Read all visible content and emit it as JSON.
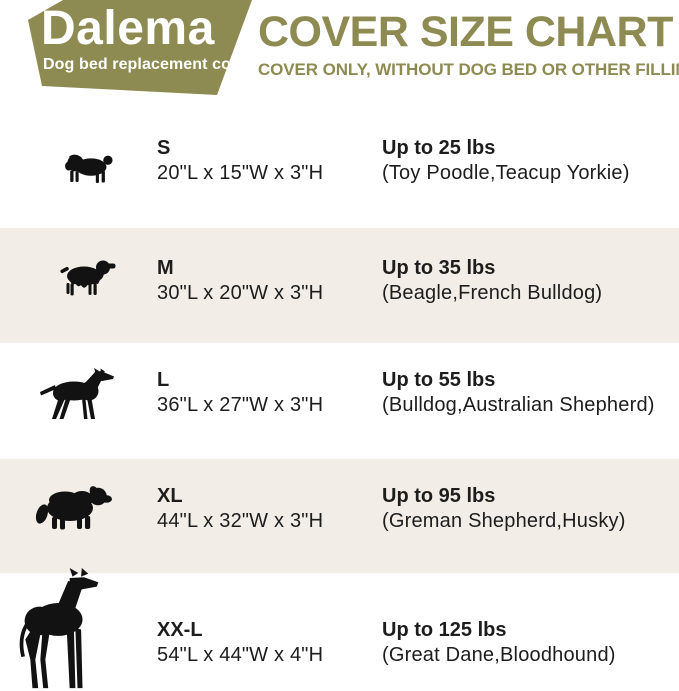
{
  "brand": {
    "name": "Dalema",
    "tagline": "Dog bed replacement cover"
  },
  "header": {
    "title": "COVER SIZE CHART",
    "subtitle": "COVER ONLY, WITHOUT DOG BED OR OTHER FILLINGS"
  },
  "colors": {
    "olive": "#8e8b52",
    "row_alt": "#f2ede6",
    "text": "#1d1d1d",
    "silhouette": "#121212",
    "background": "#ffffff"
  },
  "size_rows": [
    {
      "size": "S",
      "dimensions": "20\"L x 15\"W x 3\"H",
      "weight": "Up to 25 lbs",
      "breeds": "(Toy Poodle,Teacup Yorkie)",
      "icon": "pug-silhouette"
    },
    {
      "size": "M",
      "dimensions": "30\"L x 20\"W x 3\"H",
      "weight": "Up to 35 lbs",
      "breeds": "(Beagle,French Bulldog)",
      "icon": "cocker-spaniel-silhouette"
    },
    {
      "size": "L",
      "dimensions": "36\"L x 27\"W x 3\"H",
      "weight": "Up to 55 lbs",
      "breeds": "(Bulldog,Australian Shepherd)",
      "icon": "doberman-silhouette"
    },
    {
      "size": "XL",
      "dimensions": "44\"L x 32\"W x 3\"H",
      "weight": "Up to 95 lbs",
      "breeds": "(Greman Shepherd,Husky)",
      "icon": "bernese-mountain-dog-silhouette"
    },
    {
      "size": "XX-L",
      "dimensions": "54\"L x 44\"W x 4\"H",
      "weight": "Up to 125 lbs",
      "breeds": "(Great Dane,Bloodhound)",
      "icon": "great-dane-silhouette"
    }
  ],
  "chart_data": {
    "type": "table",
    "title": "COVER SIZE CHART",
    "subtitle": "COVER ONLY, WITHOUT DOG BED OR OTHER FILLINGS",
    "columns": [
      "Size",
      "Cover dimensions",
      "Max dog weight (lbs)",
      "Example breeds"
    ],
    "rows": [
      [
        "S",
        "20\"L x 15\"W x 3\"H",
        25,
        "Toy Poodle,Teacup Yorkie"
      ],
      [
        "M",
        "30\"L x 20\"W x 3\"H",
        35,
        "Beagle,French Bulldog"
      ],
      [
        "L",
        "36\"L x 27\"W x 3\"H",
        55,
        "Bulldog,Australian Shepherd"
      ],
      [
        "XL",
        "44\"L x 32\"W x 3\"H",
        95,
        "Greman Shepherd,Husky"
      ],
      [
        "XX-L",
        "54\"L x 44\"W x 4\"H",
        125,
        "Great Dane,Bloodhound"
      ]
    ]
  }
}
